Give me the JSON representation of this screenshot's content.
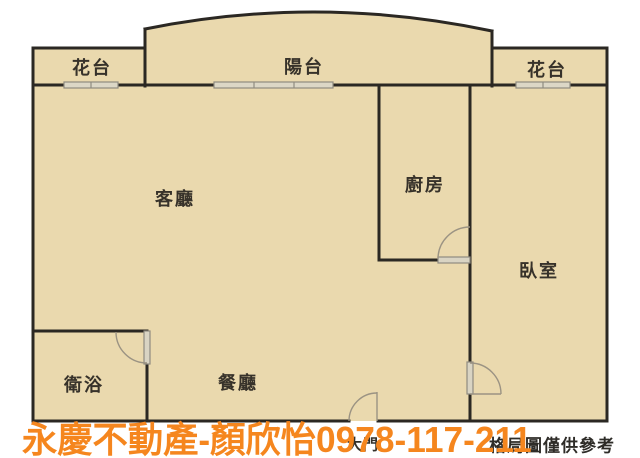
{
  "plan": {
    "rooms": {
      "living": "客廳",
      "dining": "餐廳",
      "bathroom": "衛浴",
      "kitchen": "廚房",
      "bedroom": "臥室",
      "balcony": "陽台",
      "flower_bed_left": "花台",
      "flower_bed_right": "花台",
      "main_door": "大門"
    },
    "colors": {
      "floor": "#ead9ae",
      "wall": "#2b2823",
      "window_fill": "#dcd7c6",
      "window_border": "#8f8b80",
      "door_arc": "#9b9383"
    }
  },
  "watermark": {
    "text": "永慶不動產-顏欣怡0978-117-211",
    "color": "#f5861e"
  },
  "footer": {
    "disclaimer": "格局圖僅供參考"
  }
}
